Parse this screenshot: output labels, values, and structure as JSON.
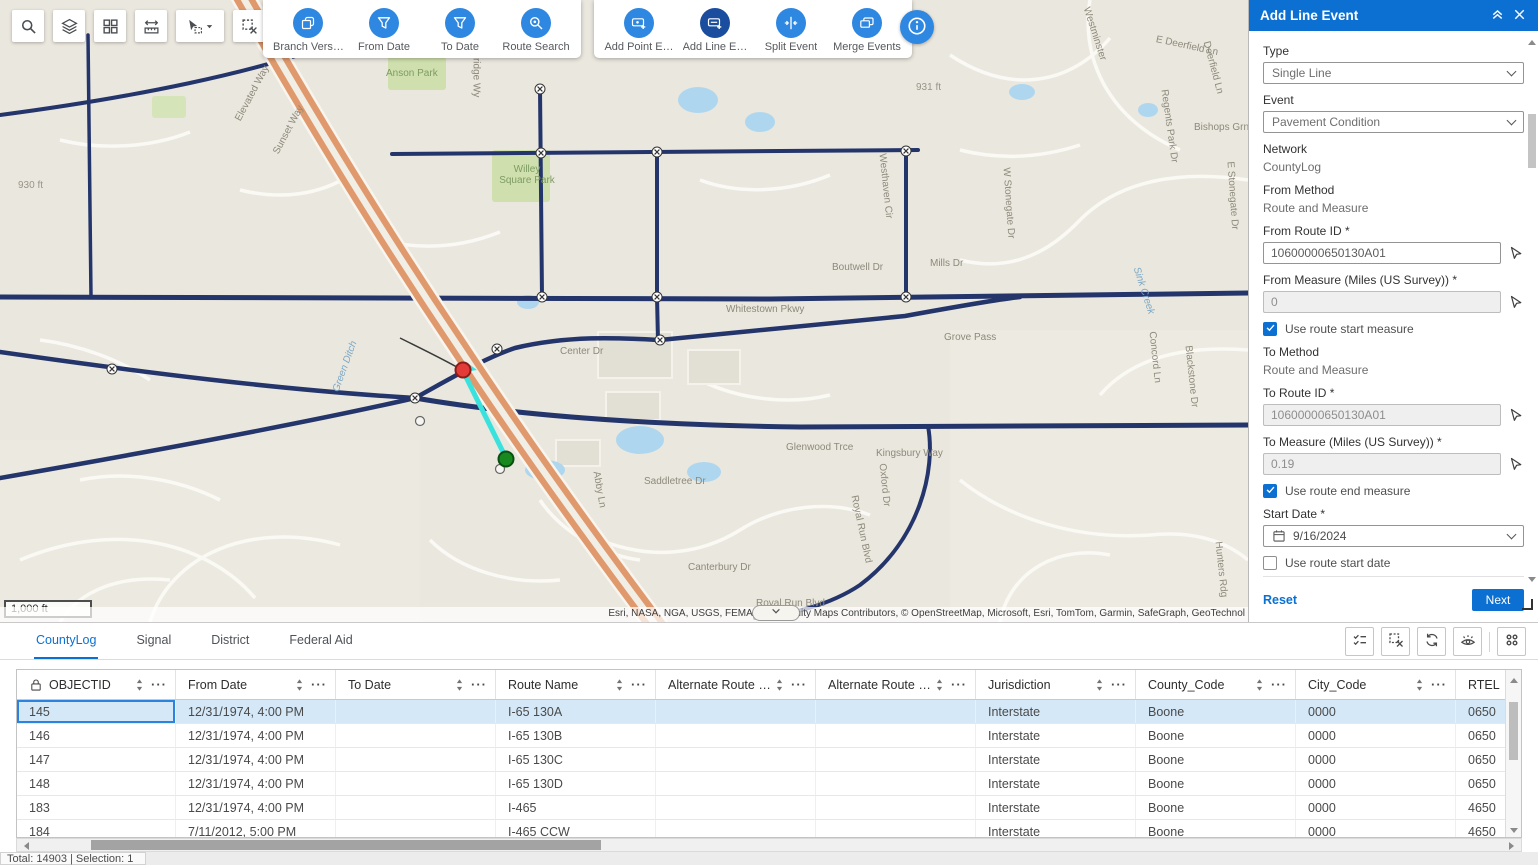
{
  "colors": {
    "accent_blue": "#0b70d2",
    "tool_circle_blue": "#2e87e0",
    "tool_circle_active": "#1b4d9e",
    "selected_row_bg": "#d4e8f8",
    "highway_orange": "#e0996c",
    "road_navy": "#24356b",
    "highlight_cyan": "#3ae2de"
  },
  "map_toolbar": {
    "buttons": [
      {
        "icon": "search",
        "name": "search-tool"
      },
      {
        "icon": "layers",
        "name": "layers-tool"
      },
      {
        "icon": "grid",
        "name": "overview-windows-tool"
      },
      {
        "icon": "measure",
        "name": "measure-tool"
      },
      {
        "icon": "select",
        "name": "select-tool",
        "caret": true
      },
      {
        "icon": "clearsel",
        "name": "clear-selection-tool"
      },
      {
        "icon": "routesel",
        "name": "route-selection-tool",
        "gap": true
      }
    ]
  },
  "event_tools": {
    "group1": [
      {
        "label": "Branch Vers…",
        "icon": "branch",
        "name": "branch-versions-tool"
      },
      {
        "label": "From Date",
        "icon": "filter",
        "name": "from-date-filter-tool"
      },
      {
        "label": "To Date",
        "icon": "filter",
        "name": "to-date-filter-tool"
      },
      {
        "label": "Route Search",
        "icon": "routesearch",
        "name": "route-search-tool"
      }
    ],
    "group2": [
      {
        "label": "Add Point E…",
        "icon": "addpoint",
        "name": "add-point-event-tool"
      },
      {
        "label": "Add Line E…",
        "icon": "addline",
        "name": "add-line-event-tool",
        "active": true
      },
      {
        "label": "Split Event",
        "icon": "split",
        "name": "split-event-tool"
      },
      {
        "label": "Merge Events",
        "icon": "merge",
        "name": "merge-events-tool"
      }
    ]
  },
  "map": {
    "scale_label": "1,000 ft",
    "attribution": "Esri, NASA, NGA, USGS, FEMA | Community Maps Contributors, © OpenStreetMap, Microsoft, Esri, TomTom, Garmin, SafeGraph, GeoTechnol",
    "labels": [
      {
        "t": "930 ft",
        "x": 18,
        "y": 180,
        "c": "elev"
      },
      {
        "t": "Elevated Way",
        "x": 238,
        "y": 115,
        "r": -62
      },
      {
        "t": "Sunset Way",
        "x": 276,
        "y": 148,
        "r": -62
      },
      {
        "t": "Anson Park",
        "x": 386,
        "y": 68,
        "c": "park"
      },
      {
        "t": "Aldridge Wy",
        "x": 476,
        "y": 38,
        "r": 90
      },
      {
        "t": "Willey Square Park",
        "x": 498,
        "y": 164,
        "c": "park",
        "w": 58
      },
      {
        "t": "931 ft",
        "x": 916,
        "y": 82,
        "c": "elev"
      },
      {
        "t": "S 700 E",
        "x": 894,
        "y": 12,
        "r": 90
      },
      {
        "t": "Westminster",
        "x": 1086,
        "y": 2,
        "r": 72
      },
      {
        "t": "E Deerfield Ln",
        "x": 1156,
        "y": 34,
        "r": 12
      },
      {
        "t": "Deerfield Ln",
        "x": 1206,
        "y": 36,
        "r": 75
      },
      {
        "t": "Regents Park Dr",
        "x": 1164,
        "y": 84,
        "r": 82
      },
      {
        "t": "Bishops Grn",
        "x": 1194,
        "y": 122
      },
      {
        "t": "Westhaven Cir",
        "x": 882,
        "y": 148,
        "r": 84
      },
      {
        "t": "W Stonegate Dr",
        "x": 1006,
        "y": 162,
        "r": 86
      },
      {
        "t": "E Stonegate Dr",
        "x": 1230,
        "y": 156,
        "r": 86
      },
      {
        "t": "Sink Creek",
        "x": 1136,
        "y": 262,
        "r": 72,
        "c": "water"
      },
      {
        "t": "Mills Dr",
        "x": 930,
        "y": 258
      },
      {
        "t": "Boutwell Dr",
        "x": 832,
        "y": 262
      },
      {
        "t": "Whitestown Pkwy",
        "x": 726,
        "y": 304
      },
      {
        "t": "Grove Pass",
        "x": 944,
        "y": 332
      },
      {
        "t": "Center Dr",
        "x": 560,
        "y": 346
      },
      {
        "t": "Concord Ln",
        "x": 1152,
        "y": 326,
        "r": 84
      },
      {
        "t": "Blackstone Dr",
        "x": 1188,
        "y": 340,
        "r": 84
      },
      {
        "t": "Green Ditch",
        "x": 336,
        "y": 386,
        "r": -70,
        "c": "water"
      },
      {
        "t": "Kingsbury Way",
        "x": 876,
        "y": 448
      },
      {
        "t": "Glenwood Trce",
        "x": 786,
        "y": 442
      },
      {
        "t": "Oxford Dr",
        "x": 882,
        "y": 458,
        "r": 84
      },
      {
        "t": "Royal Run Blvd",
        "x": 854,
        "y": 490,
        "r": 78
      },
      {
        "t": "Saddletree Dr",
        "x": 644,
        "y": 476
      },
      {
        "t": "Abby Ln",
        "x": 596,
        "y": 466,
        "r": 80
      },
      {
        "t": "Canterbury Dr",
        "x": 688,
        "y": 562
      },
      {
        "t": "Hunters Rdg",
        "x": 1218,
        "y": 536,
        "r": 84
      },
      {
        "t": "Royal Run Blvd",
        "x": 756,
        "y": 598
      }
    ]
  },
  "panel": {
    "title": "Add Line Event",
    "type_label": "Type",
    "type_value": "Single Line",
    "event_label": "Event",
    "event_value": "Pavement Condition",
    "network_label": "Network",
    "network_value": "CountyLog",
    "from_method_label": "From Method",
    "from_method_value": "Route and Measure",
    "from_route_label": "From Route ID *",
    "from_route_value": "10600000650130A01",
    "from_measure_label": "From Measure (Miles (US Survey)) *",
    "from_measure_value": "0",
    "use_route_start_measure": "Use route start measure",
    "to_method_label": "To Method",
    "to_method_value": "Route and Measure",
    "to_route_label": "To Route ID *",
    "to_route_value": "10600000650130A01",
    "to_measure_label": "To Measure (Miles (US Survey)) *",
    "to_measure_value": "0.19",
    "use_route_end_measure": "Use route end measure",
    "start_date_label": "Start Date *",
    "start_date_value": "9/16/2024",
    "use_route_start_date": "Use route start date",
    "end_date_label": "End Date",
    "end_date_placeholder": "MM/DD/YYYY",
    "use_route_end_date": "Use route end date",
    "reset_label": "Reset",
    "next_label": "Next"
  },
  "table": {
    "tabs": [
      {
        "label": "CountyLog",
        "active": true
      },
      {
        "label": "Signal"
      },
      {
        "label": "District"
      },
      {
        "label": "Federal Aid"
      }
    ],
    "columns": [
      "OBJECTID",
      "From Date",
      "To Date",
      "Route Name",
      "Alternate Route …",
      "Alternate Route …",
      "Jurisdiction",
      "County_Code",
      "City_Code",
      "RTEL"
    ],
    "rows": [
      [
        "145",
        "12/31/1974, 4:00 PM",
        "",
        "I-65 130A",
        "",
        "",
        "Interstate",
        "Boone",
        "0000",
        "0650"
      ],
      [
        "146",
        "12/31/1974, 4:00 PM",
        "",
        "I-65 130B",
        "",
        "",
        "Interstate",
        "Boone",
        "0000",
        "0650"
      ],
      [
        "147",
        "12/31/1974, 4:00 PM",
        "",
        "I-65 130C",
        "",
        "",
        "Interstate",
        "Boone",
        "0000",
        "0650"
      ],
      [
        "148",
        "12/31/1974, 4:00 PM",
        "",
        "I-65 130D",
        "",
        "",
        "Interstate",
        "Boone",
        "0000",
        "0650"
      ],
      [
        "183",
        "12/31/1974, 4:00 PM",
        "",
        "I-465",
        "",
        "",
        "Interstate",
        "Boone",
        "0000",
        "4650"
      ],
      [
        "184",
        "7/11/2012, 5:00 PM",
        "",
        "I-465 CCW",
        "",
        "",
        "Interstate",
        "Boone",
        "0000",
        "4650"
      ]
    ],
    "selected_row": 0,
    "status": "Total: 14903 | Selection: 1"
  }
}
